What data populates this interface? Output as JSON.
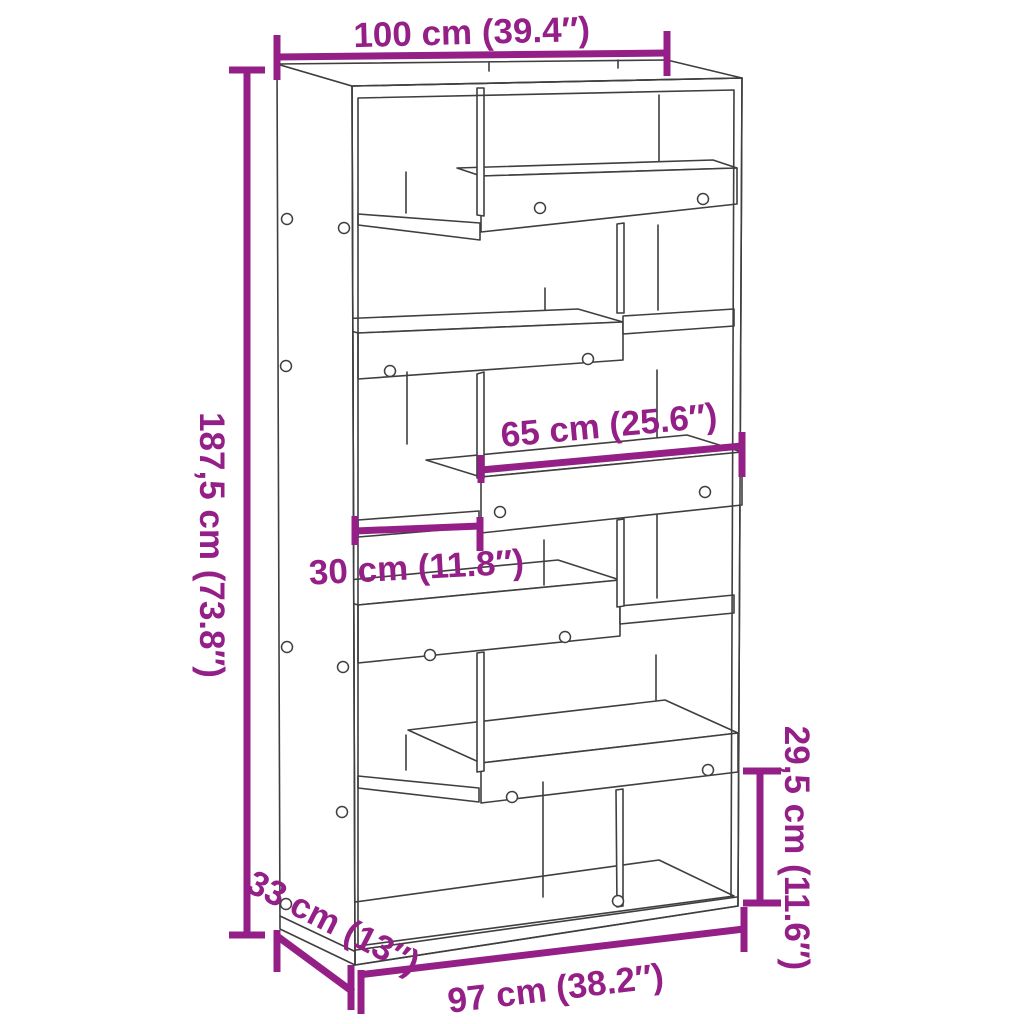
{
  "diagram": {
    "type": "product-dimension-diagram",
    "product": "bookcase-room-divider",
    "colors": {
      "accent": "#942087",
      "outline": "#3f3f3f",
      "background": "#ffffff"
    },
    "dimensions": {
      "width_top": {
        "label": "100 cm (39.4″)"
      },
      "height_left": {
        "label": "187,5 cm (73.8″)"
      },
      "shelf_wide": {
        "label": "65 cm (25.6″)"
      },
      "shelf_small": {
        "label": "30 cm (11.8″)"
      },
      "bottom_cell_height": {
        "label": "29,5 cm (11.6″)"
      },
      "depth": {
        "label": "33 cm (13″)"
      },
      "width_bottom": {
        "label": "97 cm (38.2″)"
      }
    }
  }
}
